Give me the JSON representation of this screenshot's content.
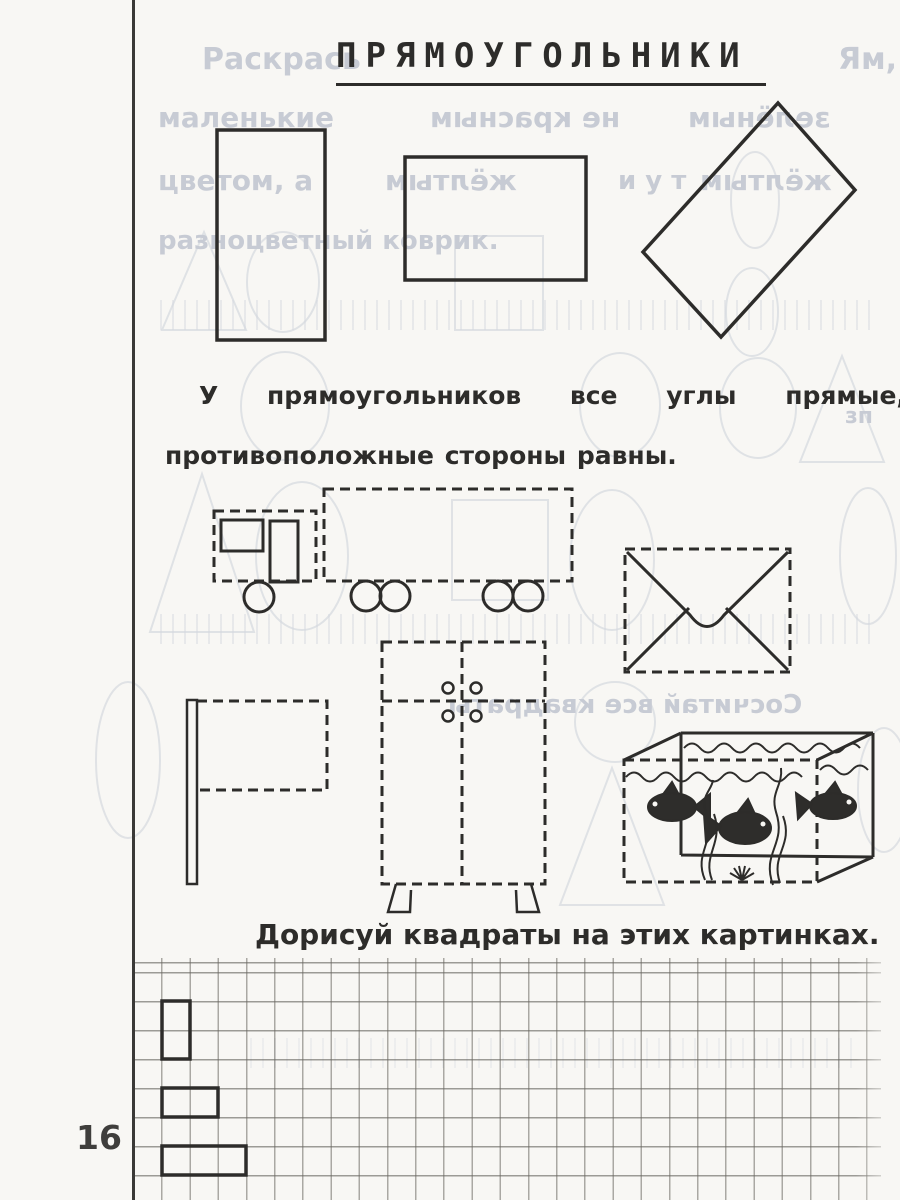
{
  "texts": {
    "title": "ПРЯМОУГОЛЬНИКИ",
    "paragraph_line1": "У прямоугольников все углы прямые, а",
    "paragraph_line2": "противоположные стороны равны.",
    "instruction": "Дорисуй квадраты на этих картинках.",
    "page_number": "16"
  },
  "bleed": {
    "note": "faint show-through from reverse page",
    "fragments": [
      {
        "text": "Раскрась",
        "mirrored": false
      },
      {
        "text": "Ям,",
        "mirrored": false
      },
      {
        "text": "маленькие",
        "mirrored": false
      },
      {
        "text": "не красным",
        "mirrored": true
      },
      {
        "text": "зелёным",
        "mirrored": true
      },
      {
        "text": "цветом, а",
        "mirrored": false
      },
      {
        "text": "жёлтым",
        "mirrored": true
      },
      {
        "text": "и у т",
        "mirrored": false
      },
      {
        "text": "жёлтым",
        "mirrored": true
      },
      {
        "text": "разноцветный коврик.",
        "mirrored": false
      },
      {
        "text": "зп",
        "mirrored": false
      },
      {
        "text": "Сосчитай все квадраты",
        "mirrored": true
      }
    ]
  },
  "colors": {
    "ink": "#2d2c2a",
    "paper": "#f8f7f4",
    "bleed": "#c7cbd4",
    "grid_line": "#69675f"
  }
}
